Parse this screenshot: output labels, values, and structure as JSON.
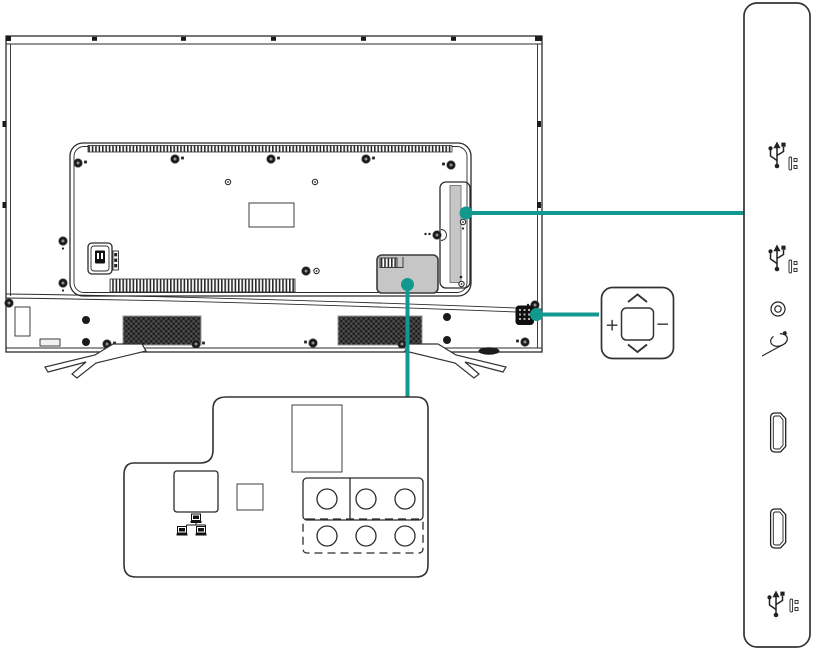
{
  "diagram": {
    "type": "tv-rear-connections-diagram",
    "accent_color": "#12998f",
    "line_color": "#2b2b2b",
    "panel_fill": "#c6c6c6",
    "background": "#ffffff"
  },
  "tv": {
    "name": "tv-back-view",
    "features": [
      "mounting-screws",
      "top-vent-strip",
      "bottom-vent-strip",
      "label-plate",
      "ac-power-inlet",
      "side-port-recess",
      "bottom-port-cover",
      "speaker-grille-left",
      "speaker-grille-right",
      "control-joystick",
      "stand-leg-left",
      "stand-leg-right"
    ]
  },
  "callouts": {
    "side_ports": {
      "ports": [
        {
          "icon": "usb-icon"
        },
        {
          "icon": "usb-icon"
        },
        {
          "icon": "audio-jack-icon"
        },
        {
          "icon": "av-input-icon"
        },
        {
          "icon": "hdmi-port-icon"
        },
        {
          "icon": "hdmi-port-icon"
        },
        {
          "icon": "usb-icon"
        }
      ]
    },
    "control": {
      "plus_label": "+",
      "minus_label": "−",
      "up_icon": "chevron-up-icon",
      "down_icon": "chevron-down-icon",
      "center": "joystick-center-button"
    },
    "bottom_ports": {
      "items": [
        "lan-port-square",
        "network-icon",
        "small-square-port",
        "power-slot",
        "circular-jack-group-top",
        "circular-jack-group-bottom-dashed"
      ],
      "circular_jack_count": 6
    }
  }
}
